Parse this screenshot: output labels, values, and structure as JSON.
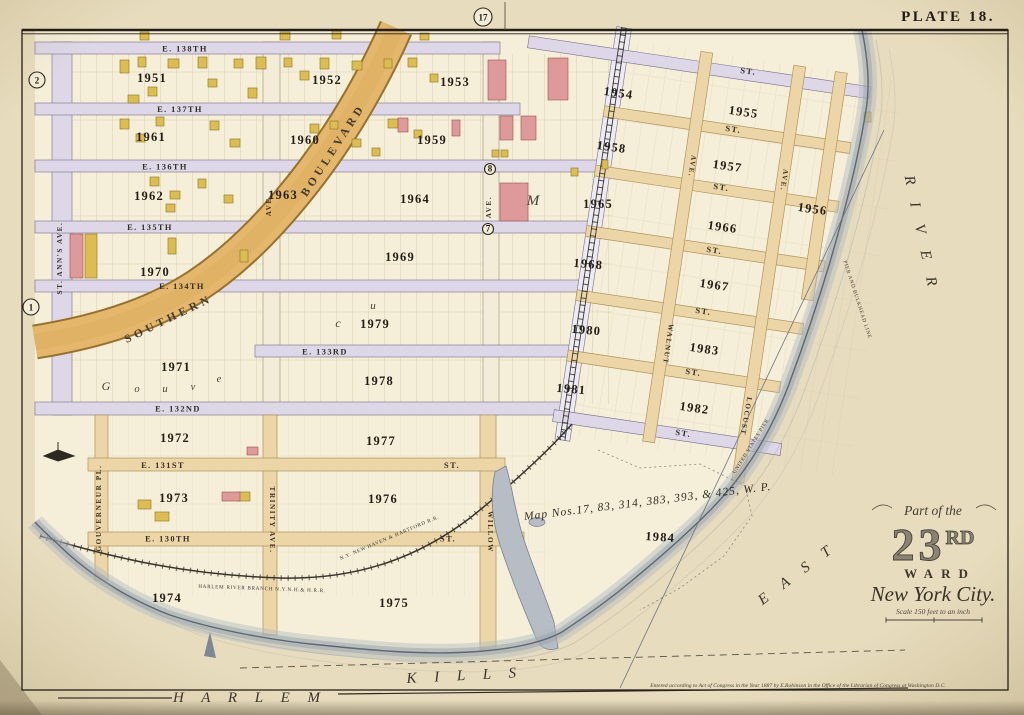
{
  "plate": {
    "label": "PLATE 18."
  },
  "cartouche": {
    "part_of": "Part of the",
    "number_big": "23",
    "number_sup": "RD",
    "ward_word": "WARD",
    "city": "New York City.",
    "scale": "Scale 150 feet to an inch"
  },
  "notes": {
    "map_nos": "Map Nos.17, 83, 314, 383, 393, & 425, W. P.",
    "copyright": "Entered according to Act of Congress in the Year 1887 by E.Robinson in the Office of the Librarian of Congress at Washington D.C."
  },
  "colors": {
    "paper": "#e9dec0",
    "land": "#f5eed8",
    "street_lavender": "#ded7e7",
    "street_tan": "#ecd5a6",
    "boulevard": "#e5b76c",
    "building_yellow": "#dcbd52",
    "building_pink": "#de9a9b",
    "water_shore": "#9aa4ae",
    "ink": "#2b261d"
  },
  "badges": [
    [
      "17",
      483,
      17,
      9
    ],
    [
      "2",
      37,
      80,
      8
    ],
    [
      "1",
      31,
      307,
      8
    ],
    [
      "8",
      490,
      169,
      5.5
    ],
    [
      "7",
      488,
      229,
      5.5
    ]
  ],
  "blocks": [
    [
      "1951",
      152,
      82
    ],
    [
      "1952",
      327,
      84
    ],
    [
      "1953",
      455,
      86
    ],
    [
      "1959",
      432,
      144
    ],
    [
      "1960",
      305,
      144
    ],
    [
      "1961",
      151,
      141
    ],
    [
      "1962",
      149,
      200
    ],
    [
      "1963",
      283,
      199
    ],
    [
      "1964",
      415,
      203
    ],
    [
      "1969",
      400,
      261
    ],
    [
      "1970",
      155,
      276
    ],
    [
      "1971",
      176,
      371
    ],
    [
      "1979",
      375,
      328
    ],
    [
      "1978",
      379,
      385
    ],
    [
      "1972",
      175,
      442
    ],
    [
      "1977",
      381,
      445
    ],
    [
      "1973",
      174,
      502
    ],
    [
      "1976",
      383,
      503
    ],
    [
      "1974",
      167,
      602
    ],
    [
      "1975",
      394,
      607
    ],
    [
      "1965",
      598,
      208
    ],
    [
      "1954",
      618,
      97,
      8
    ],
    [
      "1955",
      743,
      116,
      8
    ],
    [
      "1958",
      611,
      151,
      8
    ],
    [
      "1957",
      727,
      170,
      8
    ],
    [
      "1956",
      812,
      213,
      8
    ],
    [
      "1966",
      722,
      231,
      8
    ],
    [
      "1968",
      588,
      268,
      5
    ],
    [
      "1967",
      714,
      289,
      8
    ],
    [
      "1980",
      586,
      334,
      5
    ],
    [
      "1983",
      704,
      353,
      8
    ],
    [
      "1981",
      571,
      393,
      5
    ],
    [
      "1982",
      694,
      412,
      8
    ],
    [
      "1984",
      660,
      541,
      4
    ]
  ],
  "street_labels": [
    [
      "E. 138TH",
      185,
      51.5,
      0
    ],
    [
      "E. 137TH",
      180,
      112,
      0
    ],
    [
      "E. 136TH",
      165,
      169.5,
      0
    ],
    [
      "E. 135TH",
      150,
      230,
      0
    ],
    [
      "E. 134TH",
      182,
      289,
      0
    ],
    [
      "E. 133RD",
      325,
      354.5,
      0
    ],
    [
      "E. 132ND",
      178,
      411.5,
      0
    ],
    [
      "E. 131ST",
      163,
      468,
      0
    ],
    [
      "ST.",
      452,
      468,
      0
    ],
    [
      "E. 130TH",
      168,
      541.5,
      0
    ],
    [
      "ST.",
      448,
      541.5,
      0
    ],
    [
      "ST.",
      748,
      74,
      7
    ],
    [
      "ST.",
      733,
      132,
      8
    ],
    [
      "ST.",
      721,
      190,
      8
    ],
    [
      "ST.",
      714,
      253,
      8
    ],
    [
      "ST.",
      703,
      314,
      8
    ],
    [
      "ST.",
      693,
      375,
      8
    ],
    [
      "ST.",
      683,
      436,
      8
    ]
  ],
  "avenue_labels": [
    [
      "ST. ANN'S AVE.",
      62,
      258,
      -90
    ],
    [
      "AVE.",
      271,
      205,
      -90
    ],
    [
      "AVE.",
      491,
      207,
      -90
    ],
    [
      "GOUVERNEUR PL.",
      101,
      508,
      -90
    ],
    [
      "TRINITY AVE.",
      270,
      520,
      90
    ],
    [
      "WILLOW",
      488,
      532,
      90
    ],
    [
      "AVE.",
      690,
      166,
      98
    ],
    [
      "WALNUT",
      666,
      344,
      98
    ],
    [
      "AVE.",
      782,
      180,
      98
    ],
    [
      "LOCUST",
      744,
      416,
      100
    ]
  ],
  "blvd_labels": [
    [
      "SOUTHERN",
      170,
      322,
      -26
    ],
    [
      "BOULEVARD",
      336,
      152,
      -57
    ]
  ],
  "water_labels": [
    [
      "R I V E R",
      917,
      235,
      78,
      16
    ],
    [
      "E A S T",
      800,
      577,
      -37,
      15
    ],
    [
      "H A R L E M",
      250,
      702,
      0,
      13
    ],
    [
      "K I L L S",
      465,
      680,
      -3,
      13
    ]
  ],
  "rr_labels": [
    [
      "HARLEM RIVER BRANCH N.Y.N.H.& H.R.R.",
      262,
      590,
      2
    ],
    [
      "N.Y. NEW HAVEN & HARTFORD R.R.",
      390,
      539,
      -23
    ],
    [
      "PIER AND BULKHEAD LINE",
      856,
      300,
      72
    ],
    [
      "UNITED STATES PIER",
      752,
      447,
      -58
    ]
  ],
  "letters": [
    [
      "M",
      533,
      205,
      0,
      15
    ],
    [
      "c",
      338,
      327,
      0,
      12
    ],
    [
      "u",
      373,
      309,
      0,
      11
    ],
    [
      "G",
      106,
      390,
      0,
      12
    ],
    [
      "o",
      137,
      392,
      0,
      10.5
    ],
    [
      "u",
      165,
      392,
      0,
      10.5
    ],
    [
      "v",
      193,
      390,
      0,
      10.5
    ],
    [
      "e",
      219,
      382,
      0,
      10.5
    ]
  ],
  "buildings": [
    [
      140,
      32,
      9,
      8,
      "y"
    ],
    [
      280,
      32,
      10,
      8,
      "y"
    ],
    [
      332,
      31,
      9,
      8,
      "y"
    ],
    [
      420,
      33,
      9,
      7,
      "y"
    ],
    [
      120,
      60,
      9,
      13,
      "y"
    ],
    [
      138,
      57,
      8,
      10,
      "y"
    ],
    [
      168,
      59,
      11,
      9,
      "y"
    ],
    [
      198,
      57,
      9,
      11,
      "y"
    ],
    [
      234,
      59,
      9,
      9,
      "y"
    ],
    [
      256,
      57,
      10,
      12,
      "y"
    ],
    [
      208,
      79,
      9,
      8,
      "y"
    ],
    [
      148,
      87,
      9,
      9,
      "y"
    ],
    [
      128,
      95,
      11,
      8,
      "y"
    ],
    [
      248,
      88,
      9,
      10,
      "y"
    ],
    [
      284,
      58,
      8,
      9,
      "y"
    ],
    [
      300,
      71,
      9,
      9,
      "y"
    ],
    [
      320,
      58,
      9,
      11,
      "y"
    ],
    [
      352,
      61,
      10,
      9,
      "y"
    ],
    [
      384,
      59,
      8,
      9,
      "y"
    ],
    [
      408,
      58,
      9,
      9,
      "y"
    ],
    [
      430,
      74,
      8,
      8,
      "y"
    ],
    [
      120,
      119,
      9,
      10,
      "y"
    ],
    [
      136,
      134,
      9,
      8,
      "y"
    ],
    [
      156,
      117,
      8,
      9,
      "y"
    ],
    [
      210,
      121,
      9,
      9,
      "y"
    ],
    [
      230,
      139,
      10,
      8,
      "y"
    ],
    [
      310,
      124,
      9,
      9,
      "y"
    ],
    [
      330,
      121,
      8,
      8,
      "y"
    ],
    [
      352,
      139,
      9,
      8,
      "y"
    ],
    [
      388,
      119,
      10,
      9,
      "y"
    ],
    [
      372,
      148,
      8,
      8,
      "y"
    ],
    [
      414,
      130,
      8,
      8,
      "y"
    ],
    [
      150,
      177,
      9,
      9,
      "y"
    ],
    [
      170,
      191,
      10,
      8,
      "y"
    ],
    [
      198,
      179,
      8,
      9,
      "y"
    ],
    [
      224,
      195,
      9,
      8,
      "y"
    ],
    [
      166,
      204,
      9,
      8,
      "y"
    ],
    [
      85,
      234,
      12,
      44,
      "y"
    ],
    [
      168,
      238,
      8,
      16,
      "y"
    ],
    [
      240,
      250,
      8,
      12,
      "y"
    ],
    [
      492,
      150,
      7,
      7,
      "y"
    ],
    [
      501,
      150,
      7,
      7,
      "y"
    ],
    [
      571,
      168,
      7,
      8,
      "y"
    ],
    [
      602,
      160,
      6,
      9,
      "y"
    ],
    [
      864,
      112,
      7,
      10,
      "y"
    ],
    [
      138,
      500,
      13,
      9,
      "y"
    ],
    [
      155,
      512,
      14,
      9,
      "y"
    ],
    [
      237,
      492,
      13,
      9,
      "y"
    ],
    [
      488,
      60,
      18,
      40,
      "p"
    ],
    [
      548,
      58,
      20,
      42,
      "p"
    ],
    [
      500,
      116,
      13,
      24,
      "p"
    ],
    [
      521,
      116,
      15,
      24,
      "p"
    ],
    [
      452,
      120,
      8,
      16,
      "p"
    ],
    [
      398,
      118,
      10,
      14,
      "p"
    ],
    [
      500,
      183,
      28,
      38,
      "p"
    ],
    [
      70,
      234,
      13,
      44,
      "p"
    ],
    [
      247,
      447,
      11,
      8,
      "p"
    ],
    [
      222,
      492,
      18,
      9,
      "p"
    ]
  ]
}
